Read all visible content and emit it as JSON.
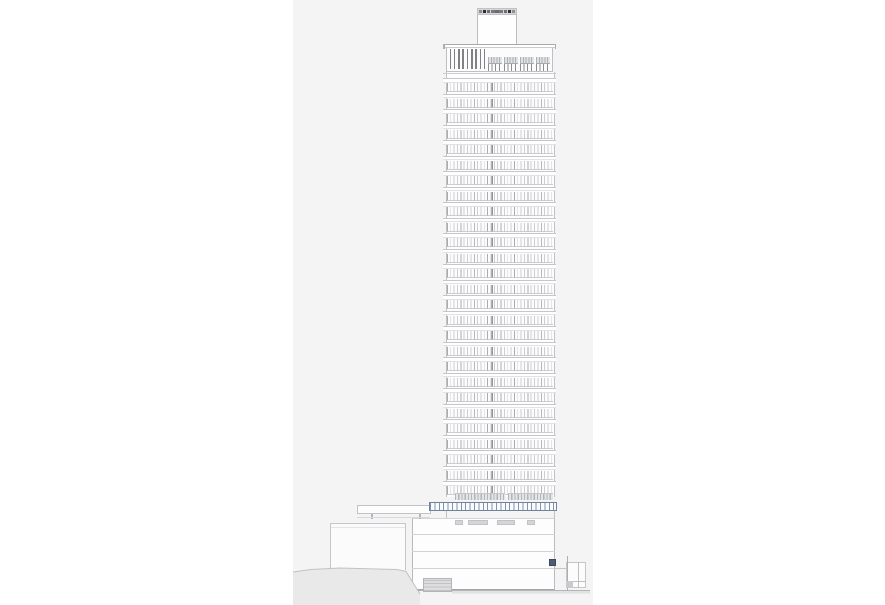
{
  "page": {
    "description": "Architectural south elevation drawing of a high-rise tower with rooftop plant, podium, left low wing and sloping ground",
    "background_color": "#ffffff",
    "sheet_color": "#f4f4f5"
  },
  "building": {
    "colors": {
      "sheet": "#f4f4f5",
      "ground_fill": "#e9e9ea",
      "ground_line": "#b3b4b7",
      "slab_line": "#c6c6ca",
      "mullion": "#9ea0a6",
      "mullion_accent": "#7a7c82",
      "louver": "#808085",
      "hatch_gray": "#aeb1b5",
      "curtainwall_blue_stroke": "#6d7f9c",
      "curtainwall_blue_border": "#6f82a0",
      "cap_dark": "#2c2c2e",
      "cap_mid": "#717175",
      "navy_equipment": "#4f5e77",
      "edge_line": "#c2c2c6"
    },
    "tower": {
      "floors": {
        "count": 27,
        "start_y": 78,
        "height": 15.5,
        "slab_left": 443,
        "slab_width": 113
      }
    },
    "roof": {
      "cap_segments": [
        "#8d8d91",
        "#2c2c2e",
        "#6f6f73",
        "#79797d",
        "#6c6c70",
        "#79797d",
        "#6f6f73",
        "#2f2f31",
        "#909094"
      ],
      "louvers": {
        "count": 9,
        "start_x": 449.5,
        "spacing": 4.3
      },
      "window_groups": {
        "count": 4,
        "start_x": 488,
        "width": 13.5,
        "spacing": 16
      },
      "parapet_tabs_x": [
        443,
        554.5
      ]
    },
    "base": {
      "hatch_strips": [
        {
          "x": 455,
          "w": 50
        },
        {
          "x": 508,
          "w": 45
        }
      ],
      "canopy_feet_x": [
        371,
        419
      ],
      "door_marks": [
        {
          "x": 455,
          "w": 8
        },
        {
          "x": 468,
          "w": 20
        },
        {
          "x": 497,
          "w": 18
        },
        {
          "x": 527,
          "w": 8
        }
      ],
      "shaft_connectors_x": [
        446,
        553.5
      ],
      "podium_floor_lines_y": [
        533.5,
        550.5,
        567.5
      ]
    },
    "ground": {
      "polygon_points": "0,572 18,569.5 47,568 104,569.5 113,571.5 127,594 127,605 0,605",
      "top_path": "M0,572 L18,569.5 L47,568 L104,569.5 L113,571.5 L127,594",
      "flat_line_path": "M127,590.5 L297,590.5",
      "road_band_path": "M159,592.3 L297,592.3"
    }
  }
}
